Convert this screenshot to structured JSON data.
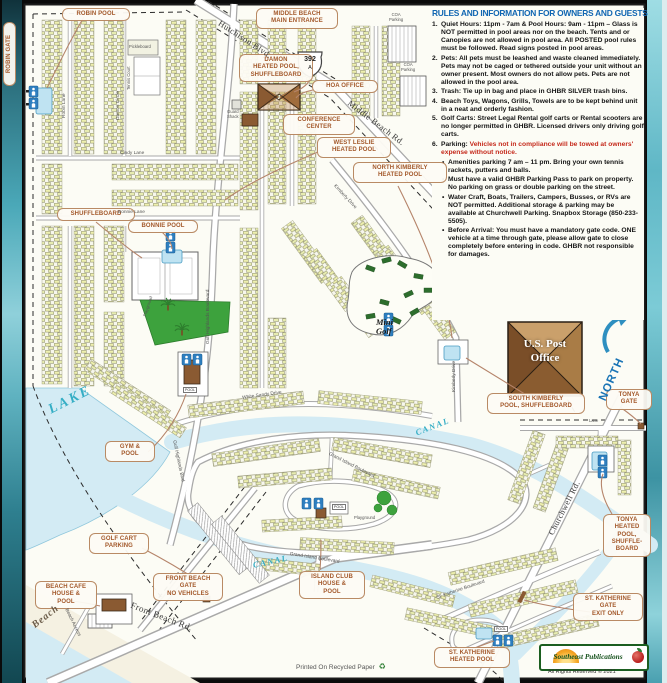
{
  "rules": {
    "title": "RULES AND INFORMATION FOR OWNERS AND GUESTS",
    "items": [
      {
        "num": "1.",
        "lead": "Quiet Hours:",
        "mid": " 11pm - 7am & ",
        "lead2": "Pool Hours:",
        "text": " 9am - 11pm – Glass is NOT permitted in pool areas nor on the beach. Tents and or Canopies are not allowed in pool area. All POSTED pool rules must be followed. Read signs posted in pool areas."
      },
      {
        "num": "2.",
        "lead": "Pets:",
        "text": " All pets must be leashed and waste cleaned immediately. Pets may not be caged or tethered outside your unit without an owner present. Most owners do not allow pets. Pets are not allowed in the pool area."
      },
      {
        "num": "3.",
        "lead": "Trash:",
        "text": " Tie up in bag and place in GHBR SILVER trash bins."
      },
      {
        "num": "4.",
        "lead": "",
        "text": "Beach Toys, Wagons, Grills, Towels are to be kept behind unit in a neat and orderly fashion."
      },
      {
        "num": "5.",
        "lead": "Golf Carts:",
        "text": " Street Legal Rental golf carts or Rental scooters are no longer permitted in GHBR. Licensed drivers only driving golf carts."
      },
      {
        "num": "6.",
        "lead": "Parking:",
        "warning": " Vehicles not in compliance will be towed at owners' expense without notice."
      }
    ],
    "parking_bullets": [
      "Amenities parking 7 am – 11 pm. Bring your own tennis rackets, putters and balls.",
      "Must have a valid GHBR Parking Pass to park on property. No parking on grass or double parking on the street.",
      "Water Craft, Boats, Trailers, Campers, Busses, or RVs are NOT permitted. Additional storage & parking may be available at Churchwell Parking. Snapbox Storage (850-233-5505).",
      "Before Arrival: You must have a mandatory gate code. ONE vehicle at a time through gate, please allow gate to close completely before entering in code. GHBR not responsible for damages."
    ]
  },
  "map": {
    "amenity_labels": [
      "ROBIN POOL",
      "ROBIN GATE",
      "MIDDLE BEACH\nMAIN ENTRANCE",
      "DAMON\nHEATED POOL,\nSHUFFLEBOARD",
      "HOA OFFICE",
      "CONFERENCE\nCENTER",
      "WEST LESLIE\nHEATED POOL",
      "NORTH KIMBERLY\nHEATED POOL",
      "SHUFFLEBOARD",
      "BONNIE POOL",
      "SOUTH KIMBERLY\nPOOL, SHUFFLEBOARD",
      "TONYA\nGATE",
      "TONYA\nHEATED\nPOOL,\nSHUFFLE-\nBOARD",
      "GYM &\nPOOL",
      "GOLF CART\nPARKING",
      "FRONT BEACH\nGATE\nNO VEHICLES",
      "BEACH CAFE\nHOUSE &\nPOOL",
      "ISLAND CLUB\nHOUSE &\nPOOL",
      "ST. KATHERINE\nHEATED POOL",
      "ST. KATHERINE\nGATE\nEXIT ONLY"
    ],
    "street_labels": [
      "Hutchison Blvd.",
      "Middle Beach Rd.",
      "Front Beach Rd.",
      "Churchwell Rd.",
      "Gulf Highlands Boulevard",
      "Gulf Highlands Blvd",
      "Robin Lane",
      "Damon Circle",
      "Cindy Lane",
      "Bonnie Lane",
      "Kimberly Drive",
      "Kimberly Drive",
      "Grand Island Boulevard",
      "Grand Island Boulevard",
      "White Sandy Drive",
      "St. Katherine Boulevard",
      "Beach Access",
      "Tennis Court",
      "Pickleboard",
      "Lane",
      "Guard\nShack",
      "COA\nParking",
      "COA\nParking",
      "Playground",
      "Playground"
    ],
    "water_labels": {
      "lake": "LAKE",
      "canal": "CANAL",
      "beach": "Beach"
    },
    "poi": {
      "mini_golf": "Mini\nGolf",
      "post_office": "U.S. Post\nOffice",
      "route_number": "392",
      "route_letter": "A",
      "north": "NORTH",
      "pool": "POOL"
    },
    "footer": {
      "printed_note": "Printed On Recycled Paper",
      "recycle_icon": "♻",
      "publisher": "Southeast Publications",
      "rights": "All Rights Reserved © 2021"
    }
  }
}
